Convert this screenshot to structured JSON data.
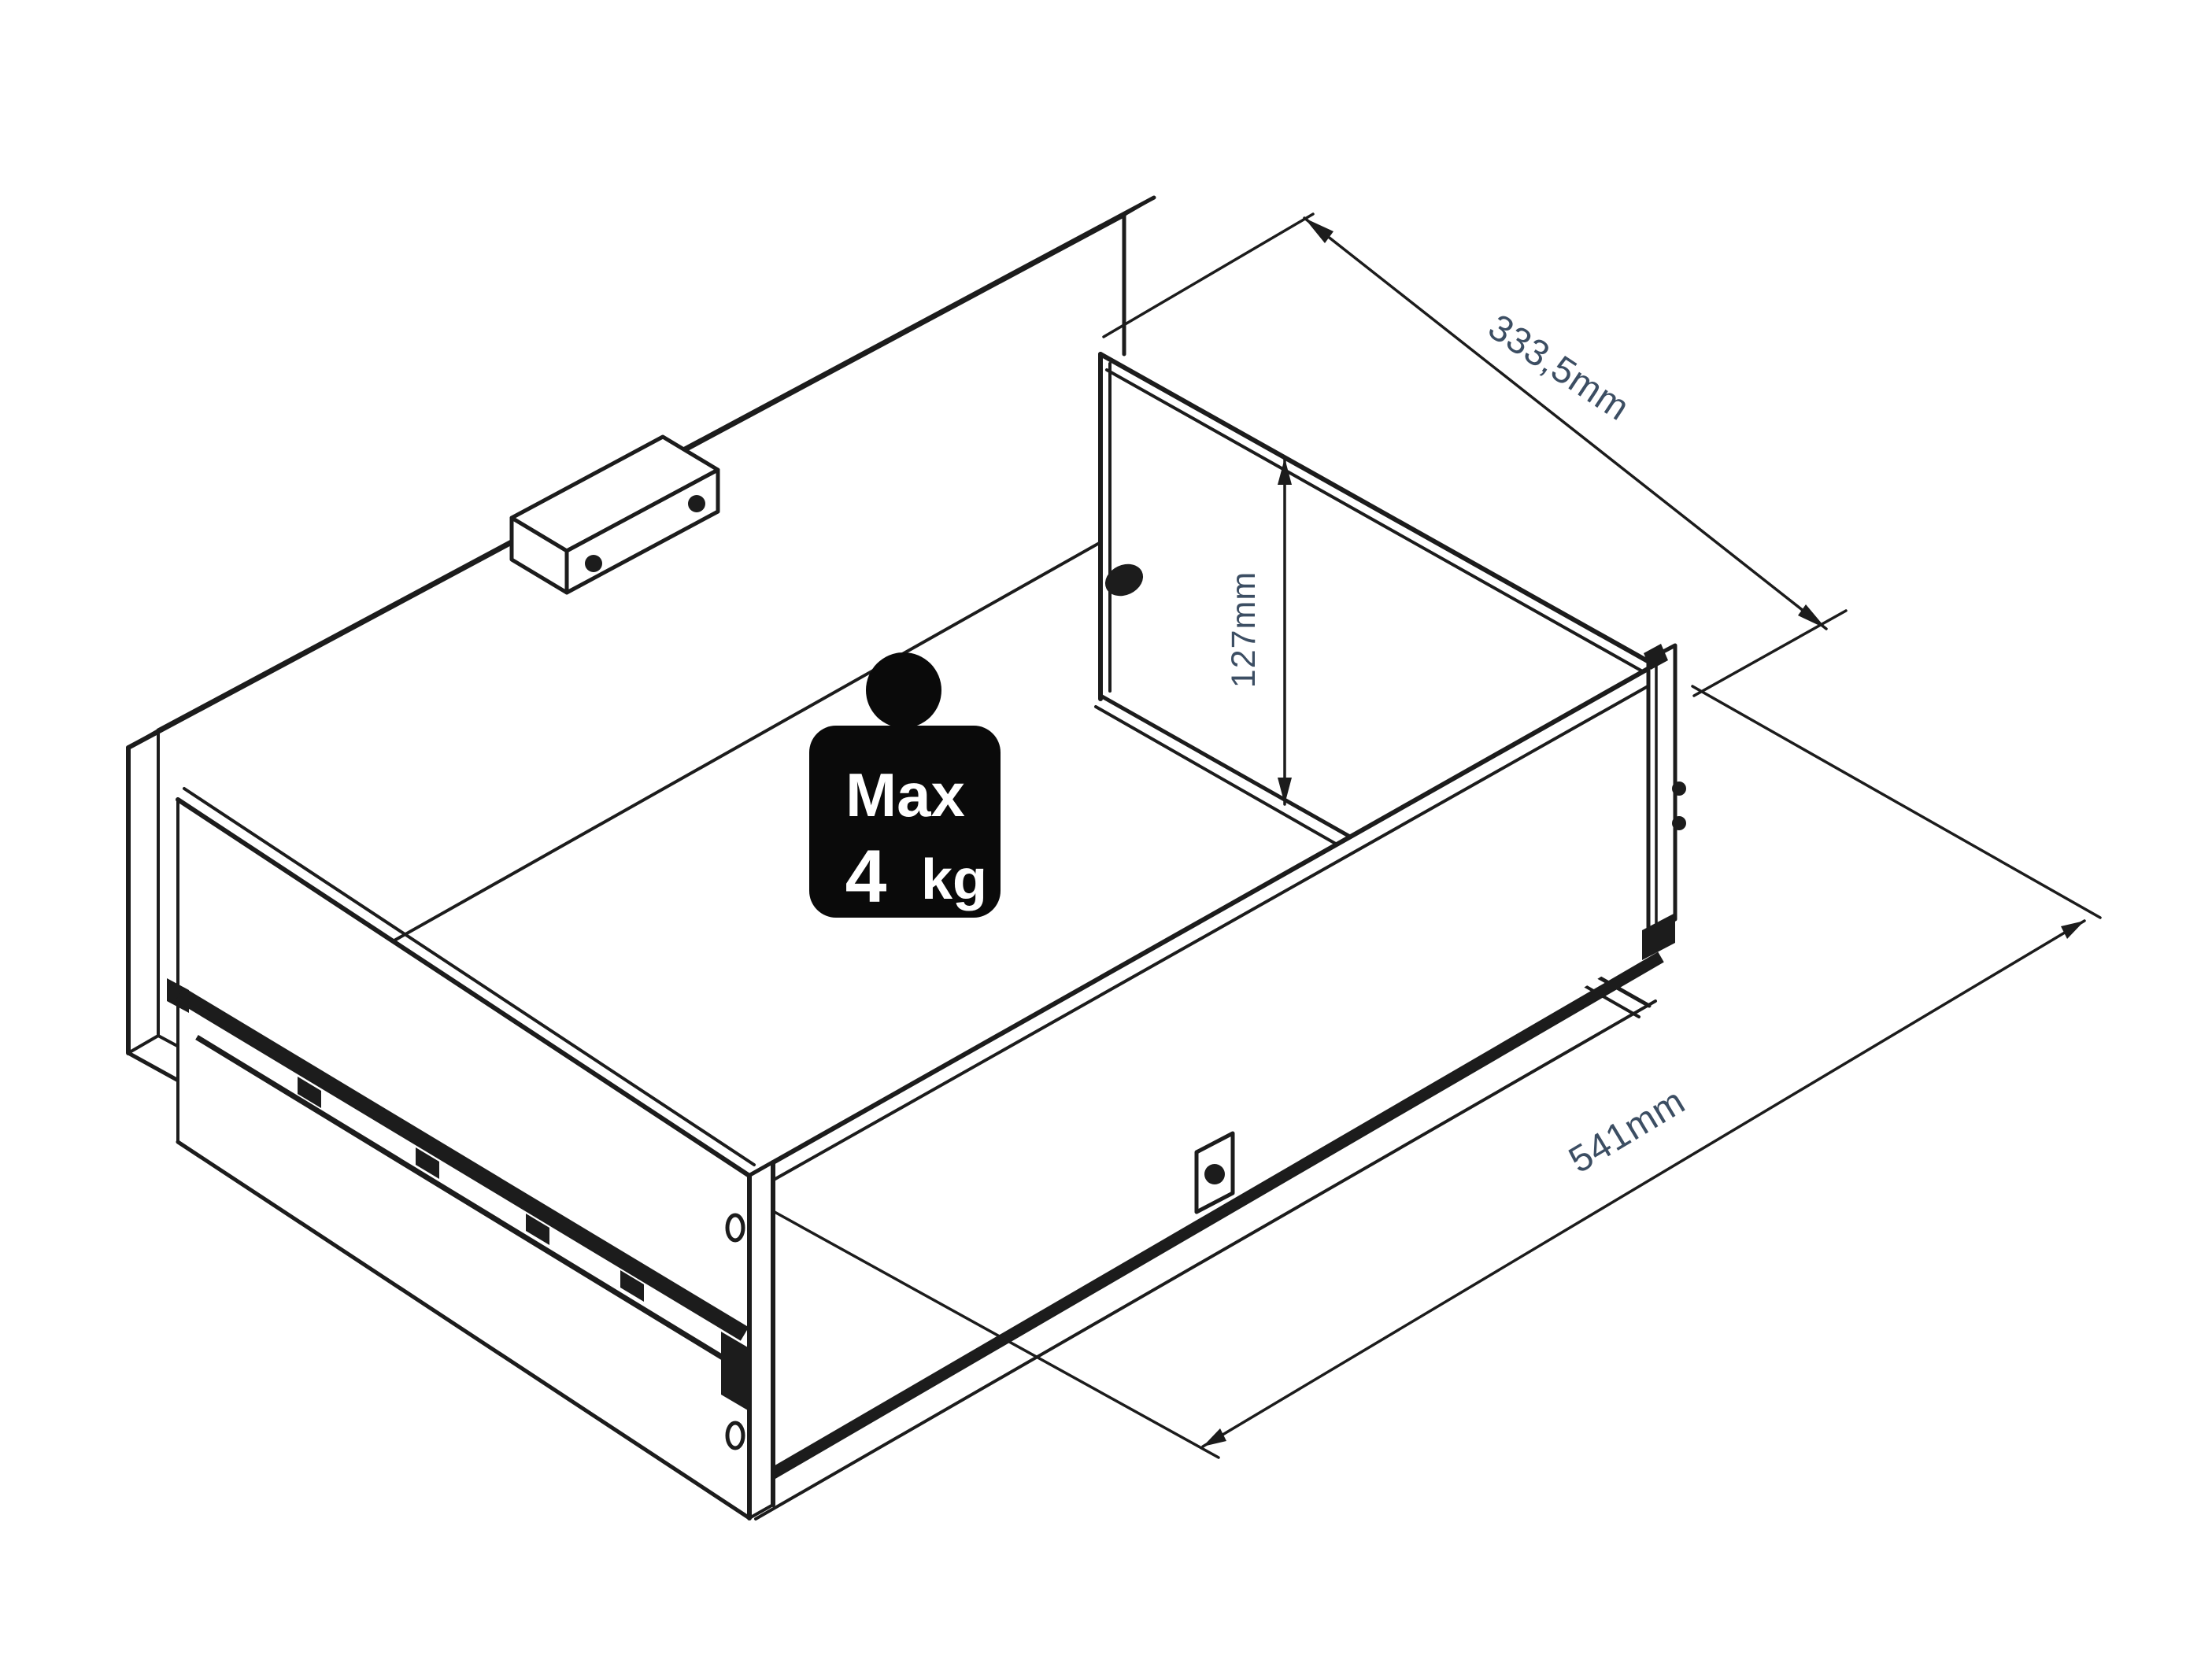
{
  "diagram": {
    "title": "drawer-assembly-isometric-drawing",
    "background_color": "#ffffff",
    "line_color": "#1c1c1c",
    "dimension_label_color": "#3c4e63",
    "dimensions": {
      "depth_label": "333,5mm",
      "height_label": "127mm",
      "width_label": "541mm"
    },
    "weight_badge": {
      "color": "#0a0a0a",
      "text_color": "#ffffff",
      "line1": "Max",
      "value": "4",
      "unit": "kg"
    }
  }
}
